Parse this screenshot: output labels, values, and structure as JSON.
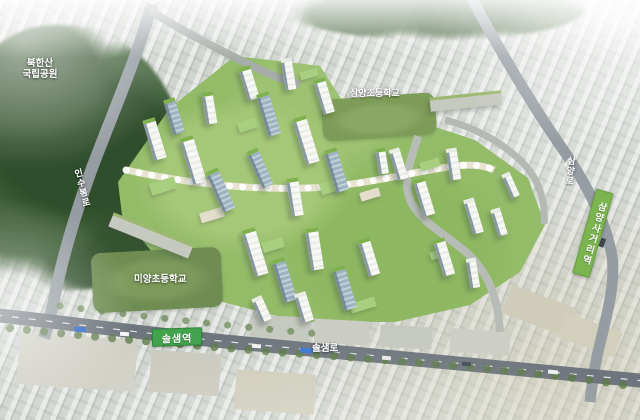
{
  "scene": {
    "description": "Aerial bird's-eye rendering of the Solsaem / Samyang urban redevelopment masterplan in Gangbuk, Seoul"
  },
  "labels": {
    "park": {
      "line1": "북한산",
      "line2": "국립공원"
    },
    "road_insubong": "인수봉로",
    "school_samyang": "삼양초등학교",
    "road_samyang": "삼양로",
    "station_samyangsageori": "삼양사거리역",
    "school_miyang": "미양초등학교",
    "station_solsaem": "솔샘역",
    "road_solsaem": "솔샘로"
  },
  "colors": {
    "station_badge_green": "#43a34d",
    "station_ribbon_green": "#7cb450",
    "label_text_white": "#ffffff",
    "forest_green": "#33502e",
    "site_green": "#93bb68",
    "roof_green": "#7fb24f",
    "road_gray": "#8d9499",
    "main_road_gray": "#6e757c",
    "city_fabric_gray": "#cbd0ca"
  }
}
